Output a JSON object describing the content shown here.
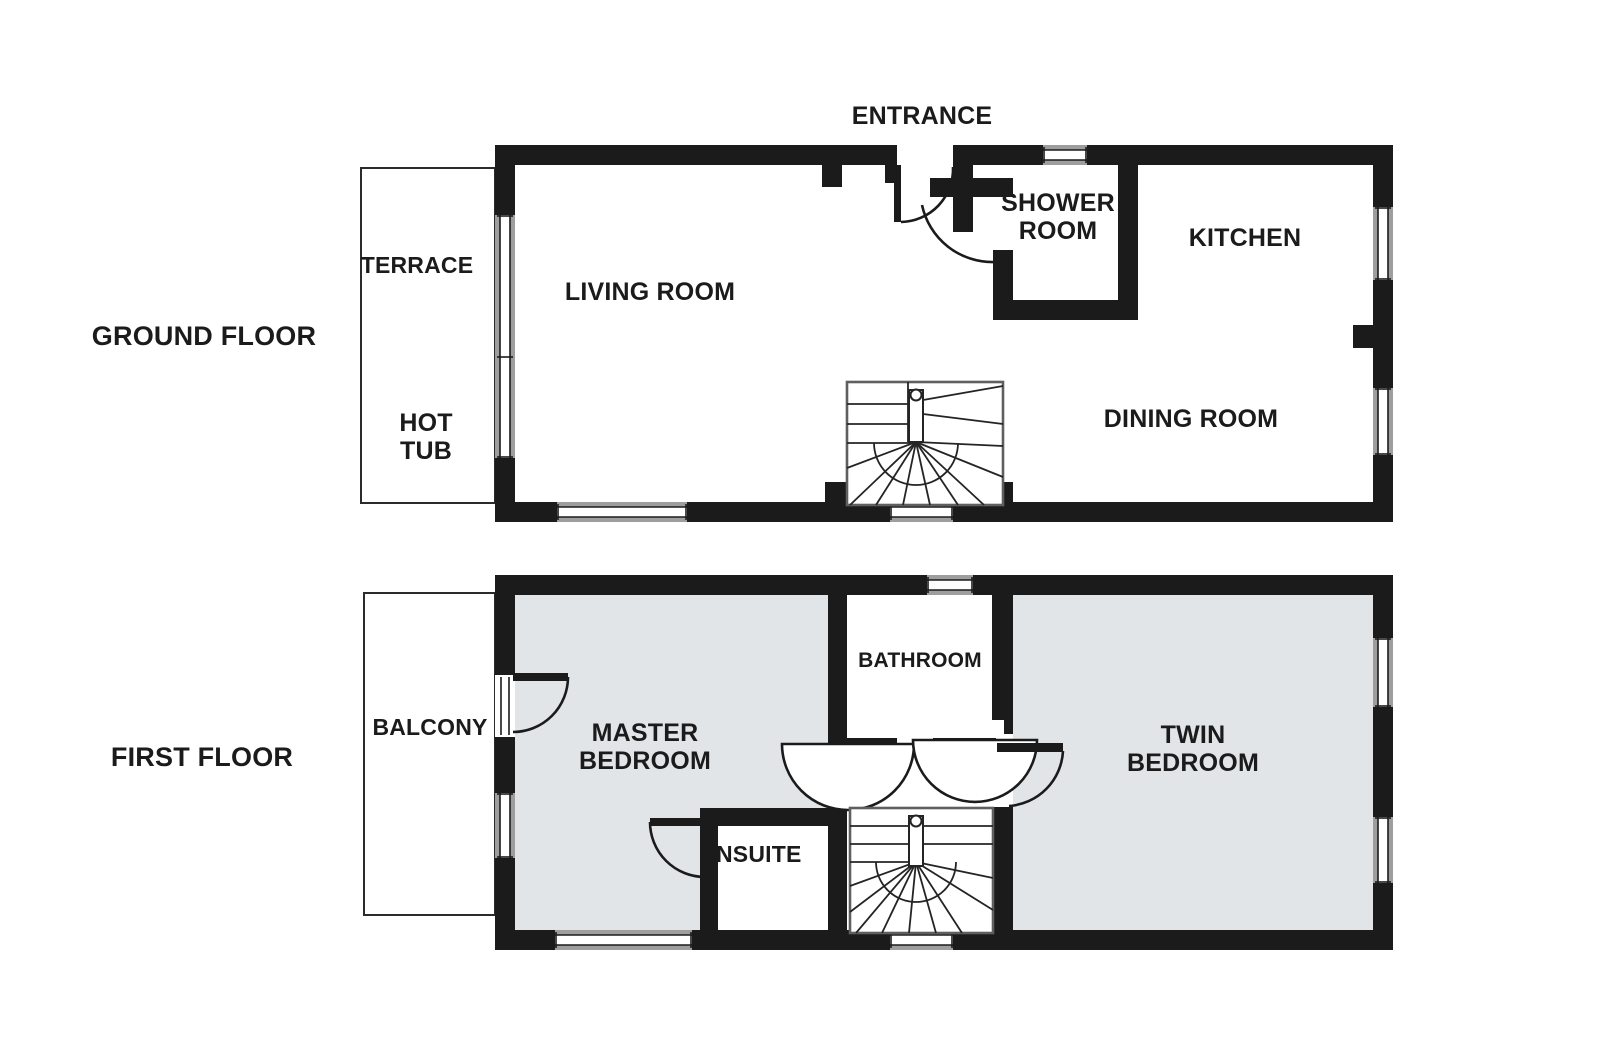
{
  "document_type": "property floor plan",
  "colors": {
    "wall": "#1b1b1b",
    "bedroom_fill": "#e1e5e8",
    "window_gray": "#9e9e9e",
    "outline": "#2b2b2b",
    "background": "#ffffff",
    "text": "#1b1b1b"
  },
  "floors": {
    "ground": {
      "title": "GROUND FLOOR",
      "rooms": {
        "terrace": "TERRACE",
        "hot_tub": "HOT\nTUB",
        "living_room": "LIVING ROOM",
        "entrance": "ENTRANCE",
        "shower_room": "SHOWER\nROOM",
        "kitchen": "KITCHEN",
        "dining_room": "DINING ROOM"
      }
    },
    "first": {
      "title": "FIRST FLOOR",
      "rooms": {
        "balcony": "BALCONY",
        "master_bedroom": "MASTER\nBEDROOM",
        "bathroom": "BATHROOM",
        "ensuite": "ENSUITE",
        "twin_bedroom": "TWIN\nBEDROOM"
      }
    }
  }
}
